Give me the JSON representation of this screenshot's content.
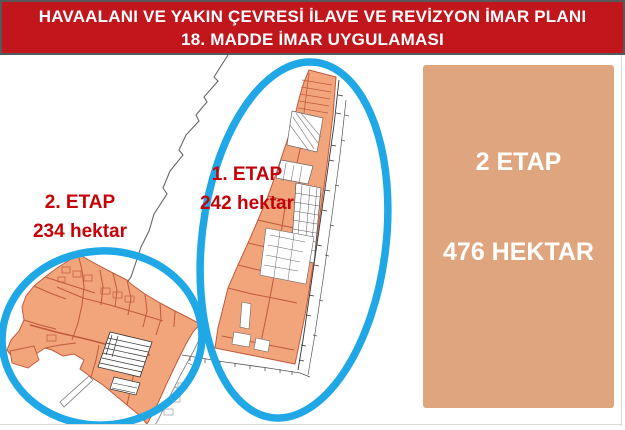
{
  "slide": {
    "title_line1": "HAVAALANI VE YAKIN ÇEVRESİ İLAVE VE REVİZYON İMAR PLANI",
    "title_line2": "18. MADDE İMAR UYGULAMASI"
  },
  "map": {
    "regions": [
      {
        "id": "etap1",
        "label": "1. ETAP",
        "area": "242 hektar",
        "area_hectares": 242
      },
      {
        "id": "etap2",
        "label": "2. ETAP",
        "area": "234 hektar",
        "area_hectares": 234
      }
    ]
  },
  "summary_box": {
    "line1": "2 ETAP",
    "line2": "476 HEKTAR",
    "total_hectares": 476
  },
  "colors": {
    "banner_red": "#c0161c",
    "label_red": "#c40309",
    "highlight_cyan": "#1fa8e5",
    "parcel_orange_fill": "#f2a47b",
    "parcel_orange_stroke": "#c05a3e",
    "summary_box_salmon": "#dfa57e",
    "map_line_gray": "#666666"
  }
}
